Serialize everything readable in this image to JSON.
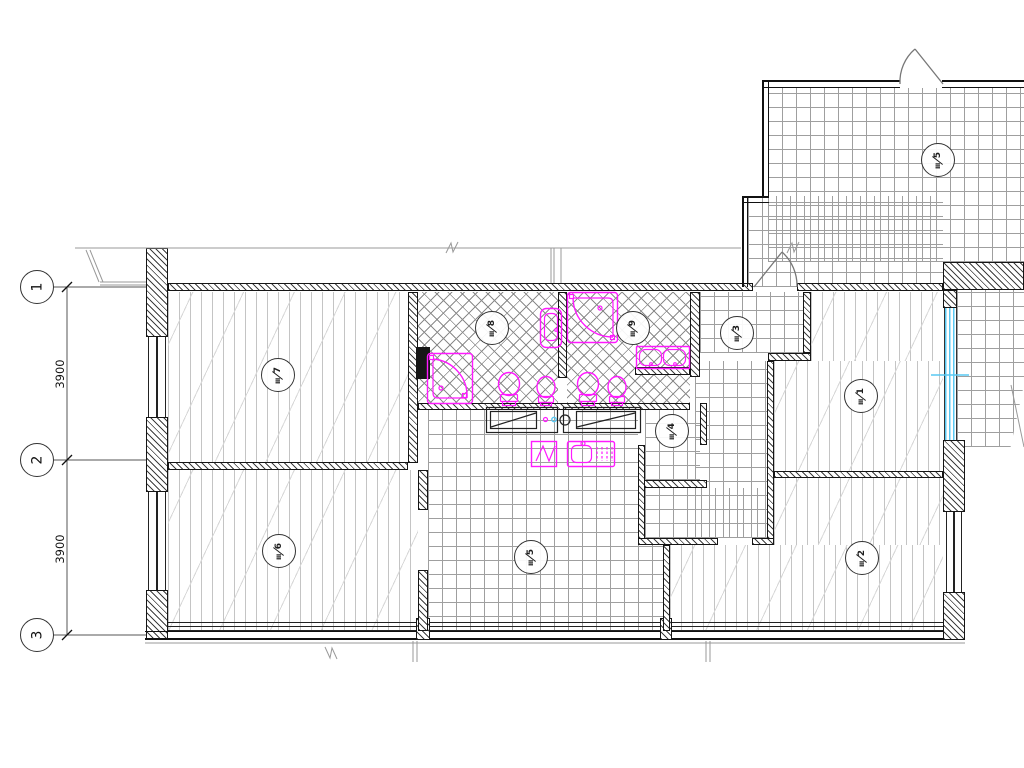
{
  "colors": {
    "fixture_magenta": "#ff1aff",
    "glass_cyan": "#59c8f2",
    "line_dark": "#161616",
    "hatch_gray": "#9f9f9f"
  },
  "grid": {
    "axis_labels": [
      "1",
      "2",
      "3"
    ],
    "spans": [
      {
        "value": "3900"
      },
      {
        "value": "3900"
      }
    ]
  },
  "markers": {
    "m7": {
      "num": "7",
      "finish": "III"
    },
    "m8": {
      "num": "8",
      "finish": "III"
    },
    "m9": {
      "num": "9",
      "finish": "III"
    },
    "m3": {
      "num": "3",
      "finish": "III"
    },
    "m1": {
      "num": "1",
      "finish": "III"
    },
    "m4": {
      "num": "4",
      "finish": "III"
    },
    "m5k": {
      "num": "5",
      "finish": "III"
    },
    "m6": {
      "num": "6",
      "finish": "III"
    },
    "m2": {
      "num": "2",
      "finish": "III"
    },
    "m5u": {
      "num": "5",
      "finish": "III"
    }
  },
  "fixtures": {
    "bathtub_left": "corner-bathtub",
    "bathtub_right": "corner-bathtub",
    "washbasin_tall": "washbasin",
    "double_washbasin": "double-washbasin",
    "toilet_1": "toilet",
    "bidet_1": "bidet",
    "toilet_2": "toilet",
    "bidet_2": "bidet",
    "washing_machine": "washing-machine",
    "kitchen_sink": "kitchen-sink"
  }
}
